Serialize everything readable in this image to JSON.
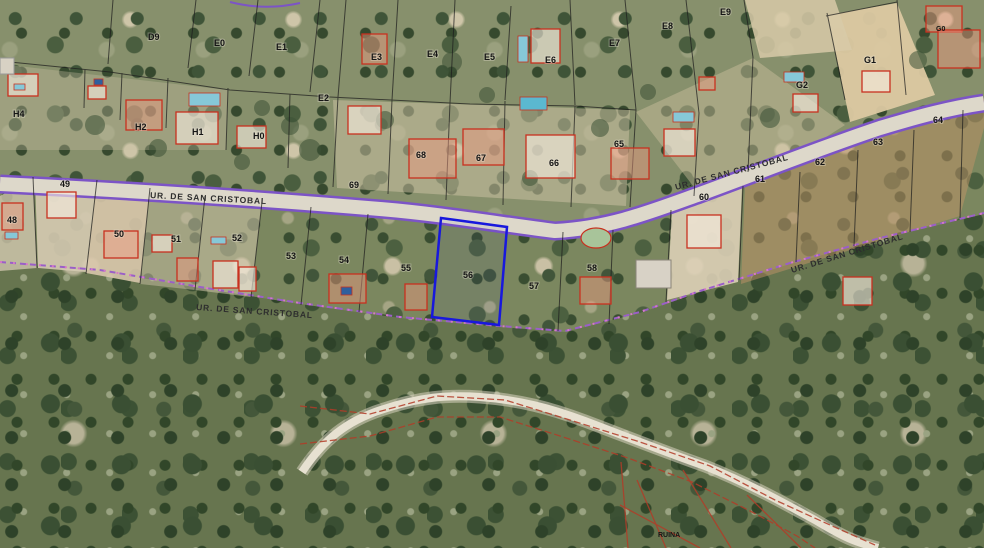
{
  "map": {
    "title": "Aerial cadastral map — Urbanización San Cristóbal",
    "street_name": "UR. DE SAN CRISTOBAL",
    "highlighted_parcel": "56",
    "colors": {
      "boundary_purple": "#7c54c6",
      "boundary_pink": "#d678c8",
      "parcel_line_black": "#1d1d1d",
      "building_red": "#c8311f",
      "highlight_blue": "#1818dd",
      "ruin_red": "#7a2418",
      "road_gray": "#ddd8ca"
    }
  },
  "street_labels": [
    {
      "text": "UR. DE SAN CRISTOBAL",
      "x": 150,
      "y": 198,
      "angle": 3
    },
    {
      "text": "UR. DE SAN CRISTOBAL",
      "x": 676,
      "y": 190,
      "angle": -15
    },
    {
      "text": "UR. DE SAN CRISTOBAL",
      "x": 792,
      "y": 273,
      "angle": -17
    },
    {
      "text": "UR. DE SAN CRISTOBAL",
      "x": 196,
      "y": 310,
      "angle": 4
    }
  ],
  "parcel_labels": [
    {
      "text": "D9",
      "x": 148,
      "y": 40
    },
    {
      "text": "E0",
      "x": 214,
      "y": 46
    },
    {
      "text": "E1",
      "x": 276,
      "y": 50
    },
    {
      "text": "E2",
      "x": 318,
      "y": 101
    },
    {
      "text": "E3",
      "x": 371,
      "y": 60
    },
    {
      "text": "E4",
      "x": 427,
      "y": 57
    },
    {
      "text": "E5",
      "x": 484,
      "y": 60
    },
    {
      "text": "E6",
      "x": 545,
      "y": 63
    },
    {
      "text": "E7",
      "x": 609,
      "y": 46
    },
    {
      "text": "E8",
      "x": 662,
      "y": 29
    },
    {
      "text": "E9",
      "x": 720,
      "y": 15
    },
    {
      "text": "H4",
      "x": 13,
      "y": 117
    },
    {
      "text": "H2",
      "x": 135,
      "y": 130
    },
    {
      "text": "H1",
      "x": 192,
      "y": 135
    },
    {
      "text": "H0",
      "x": 253,
      "y": 139
    },
    {
      "text": "G1",
      "x": 864,
      "y": 63
    },
    {
      "text": "G2",
      "x": 796,
      "y": 88
    },
    {
      "text": "48",
      "x": 7,
      "y": 223
    },
    {
      "text": "49",
      "x": 60,
      "y": 187
    },
    {
      "text": "50",
      "x": 114,
      "y": 237
    },
    {
      "text": "51",
      "x": 171,
      "y": 242
    },
    {
      "text": "52",
      "x": 232,
      "y": 241
    },
    {
      "text": "53",
      "x": 286,
      "y": 259
    },
    {
      "text": "54",
      "x": 339,
      "y": 263
    },
    {
      "text": "55",
      "x": 401,
      "y": 271
    },
    {
      "text": "56",
      "x": 463,
      "y": 278
    },
    {
      "text": "57",
      "x": 529,
      "y": 289
    },
    {
      "text": "58",
      "x": 587,
      "y": 271
    },
    {
      "text": "60",
      "x": 699,
      "y": 200
    },
    {
      "text": "61",
      "x": 755,
      "y": 182
    },
    {
      "text": "62",
      "x": 815,
      "y": 165
    },
    {
      "text": "63",
      "x": 873,
      "y": 145
    },
    {
      "text": "64",
      "x": 933,
      "y": 123
    },
    {
      "text": "65",
      "x": 614,
      "y": 147
    },
    {
      "text": "66",
      "x": 549,
      "y": 166
    },
    {
      "text": "67",
      "x": 476,
      "y": 161
    },
    {
      "text": "68",
      "x": 416,
      "y": 158
    },
    {
      "text": "69",
      "x": 349,
      "y": 188
    },
    {
      "text": "G0",
      "x": 936,
      "y": 31,
      "color": "#a02818",
      "small": true
    },
    {
      "text": "RUINA",
      "x": 658,
      "y": 537,
      "color": "#7a2418",
      "small": true
    }
  ]
}
